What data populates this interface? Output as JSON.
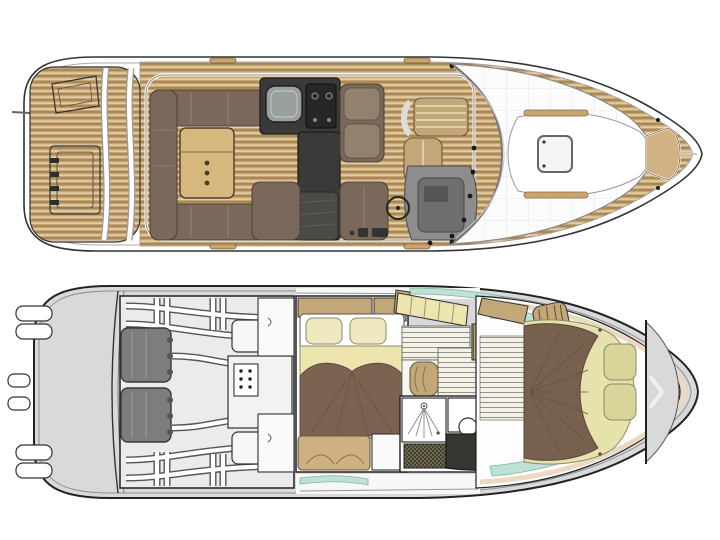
{
  "page": {
    "title": "Motor yacht floor plan — two deck views",
    "background": "#ffffff",
    "text_content": []
  },
  "palette": {
    "teak_base": "#c9a56e",
    "teak_line_dark": "#7d5f3a",
    "teak_seam": "#f3e9d2",
    "sofa_brown": "#7a685a",
    "sofa_light": "#93816f",
    "table_tan": "#d6b87e",
    "galley_charcoal": "#3a3a38",
    "galley_dark": "#262624",
    "sink_gray": "#9aa0a0",
    "khaki": "#c2a878",
    "cream": "#ece5ae",
    "pillow_cream": "#efe9c0",
    "bed_brown_mid": "#7d6252",
    "bed_brown_bow": "#77604e",
    "mattress_band": "#e6e2ac",
    "teal": "#bfe0d5",
    "teal_edge": "#7fb5a5",
    "hull_gray": "#d9d9d9",
    "engine_gray": "#7d7d7d",
    "engine_room": "#ebebeb",
    "floor_base": "#f4f2e8",
    "floor_line": "#8c8878",
    "outline": "#222222",
    "liner": "#ecd9c2"
  },
  "views": {
    "main_deck": {
      "name": "main-deck-plan",
      "regions": [
        "swim-platform",
        "platform-ladder",
        "transom-steps",
        "cockpit-sofa",
        "cockpit-table",
        "galley",
        "salon-seat",
        "companionway",
        "copilot-seat",
        "helm-seat",
        "helm-console",
        "steering-wheel",
        "side-decks",
        "windshield",
        "foredeck-sunpad",
        "foredeck-hatch",
        "grab-rails",
        "bow-deck",
        "anchor-locker"
      ]
    },
    "lower_deck": {
      "name": "lower-deck-plan",
      "regions": [
        "stern-drives",
        "engine-room",
        "port-engine",
        "starboard-engine",
        "fuel-tanks",
        "electrical-panel",
        "stringers",
        "wardrobes",
        "mid-cabin",
        "mid-cabin-bed",
        "mid-cabin-pillows",
        "mid-cabin-sofa",
        "companionway-stairs",
        "corridor-floor",
        "louver-cabinet",
        "corridor-seat",
        "shower",
        "shower-grate",
        "toilet-room",
        "vanity",
        "bow-dresser-sink",
        "bow-cabin",
        "bow-cabin-bed",
        "bow-cabin-pillows",
        "anchor-chain-locker"
      ]
    }
  }
}
